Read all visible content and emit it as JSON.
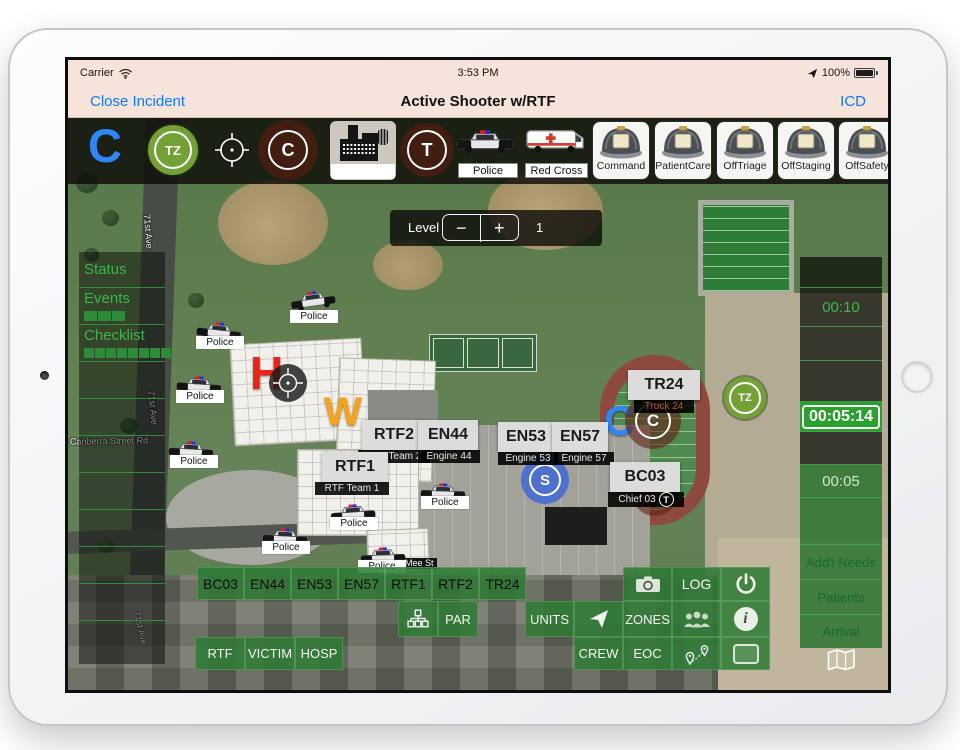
{
  "status_bar": {
    "carrier": "Carrier",
    "time": "3:53 PM",
    "battery_pct": "100%"
  },
  "nav_bar": {
    "close": "Close Incident",
    "title": "Active Shooter w/RTF",
    "icd": "ICD"
  },
  "toolbar": {
    "command_letter": "C",
    "tz_badge": "TZ",
    "c_badge": "C",
    "t_badge": "T",
    "police_label": "Police",
    "redcross_label": "Red Cross",
    "helmets": [
      {
        "label": "Command"
      },
      {
        "label": "PatientCare"
      },
      {
        "label": "OffTriage"
      },
      {
        "label": "OffStaging"
      },
      {
        "label": "OffSafety"
      }
    ]
  },
  "level_control": {
    "label": "Level",
    "minus": "−",
    "plus": "+",
    "value": "1"
  },
  "left_panel": {
    "status": "Status",
    "events": "Events",
    "checklist": "Checklist"
  },
  "right_panel": {
    "timer_short": "00:10",
    "timer_active": "00:05:14",
    "timer_small": "00:05",
    "addl_needs": "Add'l Needs",
    "patients": "Patients",
    "arrival": "Arrival"
  },
  "map": {
    "police_label": "Police",
    "h_marker": "H",
    "w_marker": "W",
    "c_marker": "C",
    "s_badge": "S",
    "tz_badge": "TZ",
    "c_badge": "C",
    "t_badge": "T",
    "street_71st": "71st Ave",
    "street_canberra": "Canberra Street Rd",
    "street_mee": "Mee St",
    "units": [
      {
        "id": "RTF2",
        "name": "RTF Team 2"
      },
      {
        "id": "RTF1",
        "name": "RTF Team 1"
      },
      {
        "id": "EN44",
        "name": "Engine 44"
      },
      {
        "id": "EN53",
        "name": "Engine 53"
      },
      {
        "id": "EN57",
        "name": "Engine 57"
      },
      {
        "id": "TR24",
        "name": "Truck 24"
      },
      {
        "id": "BC03",
        "name": "Chief 03"
      }
    ]
  },
  "bottom_bar": {
    "unit_buttons": [
      "BC03",
      "EN44",
      "EN53",
      "EN57",
      "RTF1",
      "RTF2",
      "TR24"
    ],
    "par": "PAR",
    "log": "LOG",
    "units": "UNITS",
    "zones": "ZONES",
    "crew": "CREW",
    "eoc": "EOC",
    "rtf": "RTF",
    "victim": "VICTIM",
    "hosp": "HOSP"
  },
  "colors": {
    "ios_blue": "#0a7aff",
    "button_green": "#2d7a33",
    "highlight_green": "#2aa12e",
    "marker_red": "#e8251b",
    "marker_orange": "#f7a219",
    "marker_blue": "#2f86f6"
  }
}
